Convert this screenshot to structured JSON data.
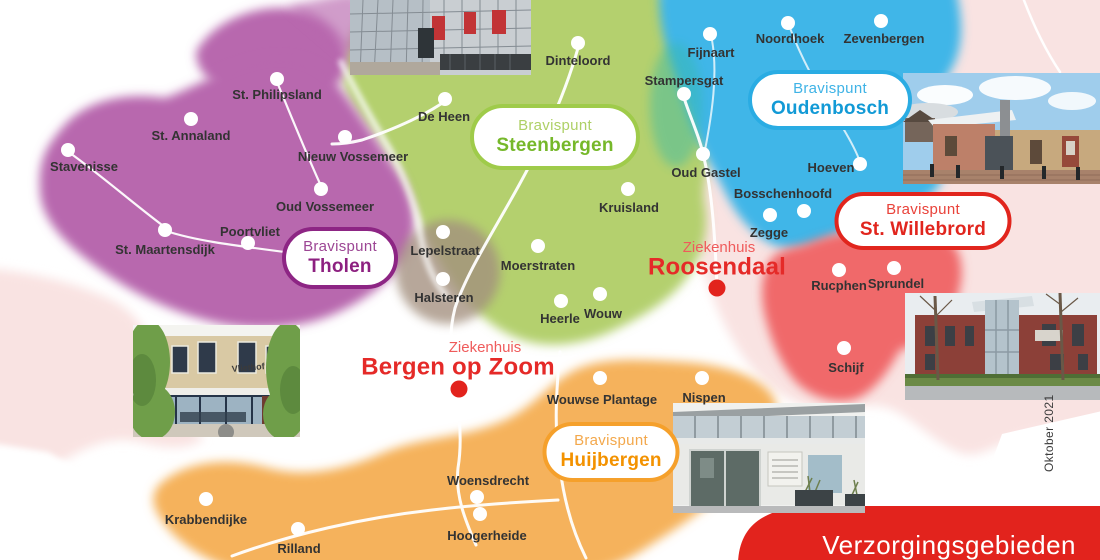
{
  "banner": {
    "label": "Verzorgingsgebieden",
    "color": "#e2231d",
    "text_color": "#ffffff"
  },
  "date_label": "Oktober 2021",
  "regions": {
    "tholen": "#b868ae",
    "steenbergen": "#b4d06e",
    "oudenbosch": "#3fb6e8",
    "st_willebrord": "#f0696b",
    "huijbergen": "#f5b25c",
    "background_land": "#f9e3e2",
    "water": "#ffffff",
    "blend_teal": "#35b9a9",
    "blend_gray": "#a38f7e",
    "road": "#ffffff",
    "town_dot": "#ffffff"
  },
  "badges": [
    {
      "line1": "Bravispunt",
      "line2": "Steenbergen",
      "border": "#9fcb4a",
      "c1": "#aed066",
      "c2": "#76b82a",
      "x": 555,
      "y": 137,
      "w": 170,
      "h": 66
    },
    {
      "line1": "Bravispunt",
      "line2": "Tholen",
      "border": "#8d2584",
      "c1": "#9c4694",
      "c2": "#8d2080",
      "x": 340,
      "y": 258,
      "w": 116,
      "h": 62
    },
    {
      "line1": "Bravispunt",
      "line2": "Oudenbosch",
      "border": "#2aace3",
      "c1": "#3fb3e6",
      "c2": "#129ad6",
      "x": 830,
      "y": 100,
      "w": 164,
      "h": 60
    },
    {
      "line1": "Bravispunt",
      "line2": "St. Willebrord",
      "border": "#e1251d",
      "c1": "#e9423a",
      "c2": "#e1251d",
      "x": 923,
      "y": 221,
      "w": 177,
      "h": 58
    },
    {
      "line1": "Bravispunt",
      "line2": "Huijbergen",
      "border": "#f5a02b",
      "c1": "#f3a84c",
      "c2": "#f39200",
      "x": 611,
      "y": 452,
      "w": 137,
      "h": 60
    }
  ],
  "hospitals": [
    {
      "line1": "Ziekenhuis",
      "line2": "Roosendaal",
      "l1x": 719,
      "l1y": 248,
      "l2x": 717,
      "l2y": 267,
      "dot_x": 717,
      "dot_y": 288
    },
    {
      "line1": "Ziekenhuis",
      "line2": "Bergen op Zoom",
      "l1x": 485,
      "l1y": 348,
      "l2x": 458,
      "l2y": 367,
      "dot_x": 459,
      "dot_y": 389
    }
  ],
  "hospital_colors": {
    "line1": "#ef5b5b",
    "line2": "#e52a28",
    "dot": "#e2231d"
  },
  "towns": [
    {
      "name": "St. Philipsland",
      "x": 277,
      "y": 79,
      "lx": 277,
      "ly": 94
    },
    {
      "name": "St. Annaland",
      "x": 191,
      "y": 119,
      "lx": 191,
      "ly": 135
    },
    {
      "name": "Stavenisse",
      "x": 68,
      "y": 150,
      "lx": 84,
      "ly": 166
    },
    {
      "name": "Nieuw Vossemeer",
      "x": 345,
      "y": 137,
      "lx": 353,
      "ly": 156
    },
    {
      "name": "Oud Vossemeer",
      "x": 321,
      "y": 189,
      "lx": 325,
      "ly": 206
    },
    {
      "name": "Poortvliet",
      "x": 248,
      "y": 243,
      "lx": 250,
      "ly": 231
    },
    {
      "name": "St. Maartensdijk",
      "x": 165,
      "y": 230,
      "lx": 165,
      "ly": 249
    },
    {
      "name": "De Heen",
      "x": 445,
      "y": 99,
      "lx": 444,
      "ly": 116
    },
    {
      "name": "Dinteloord",
      "x": 578,
      "y": 43,
      "lx": 578,
      "ly": 60
    },
    {
      "name": "Stampersgat",
      "x": 684,
      "y": 94,
      "lx": 684,
      "ly": 80
    },
    {
      "name": "Fijnaart",
      "x": 710,
      "y": 34,
      "lx": 711,
      "ly": 52
    },
    {
      "name": "Noordhoek",
      "x": 788,
      "y": 23,
      "lx": 790,
      "ly": 38
    },
    {
      "name": "Zevenbergen",
      "x": 881,
      "y": 21,
      "lx": 884,
      "ly": 38
    },
    {
      "name": "Oud Gastel",
      "x": 703,
      "y": 154,
      "lx": 706,
      "ly": 172
    },
    {
      "name": "Hoeven",
      "x": 860,
      "y": 164,
      "lx": 831,
      "ly": 167
    },
    {
      "name": "Bosschenhoofd",
      "x": 804,
      "y": 211,
      "lx": 783,
      "ly": 193
    },
    {
      "name": "Kruisland",
      "x": 628,
      "y": 189,
      "lx": 629,
      "ly": 207
    },
    {
      "name": "Zegge",
      "x": 770,
      "y": 215,
      "lx": 769,
      "ly": 232
    },
    {
      "name": "Lepelstraat",
      "x": 443,
      "y": 232,
      "lx": 445,
      "ly": 250
    },
    {
      "name": "Moerstraten",
      "x": 538,
      "y": 246,
      "lx": 538,
      "ly": 265
    },
    {
      "name": "Halsteren",
      "x": 443,
      "y": 279,
      "lx": 444,
      "ly": 297
    },
    {
      "name": "Heerle",
      "x": 561,
      "y": 301,
      "lx": 560,
      "ly": 318
    },
    {
      "name": "Wouw",
      "x": 600,
      "y": 294,
      "lx": 603,
      "ly": 313
    },
    {
      "name": "Wouwse Plantage",
      "x": 600,
      "y": 378,
      "lx": 602,
      "ly": 399
    },
    {
      "name": "Nispen",
      "x": 702,
      "y": 378,
      "lx": 704,
      "ly": 397
    },
    {
      "name": "Schijf",
      "x": 844,
      "y": 348,
      "lx": 846,
      "ly": 367
    },
    {
      "name": "Rucphen",
      "x": 839,
      "y": 270,
      "lx": 839,
      "ly": 285
    },
    {
      "name": "Sprundel",
      "x": 894,
      "y": 268,
      "lx": 896,
      "ly": 283
    },
    {
      "name": "Woensdrecht",
      "x": 477,
      "y": 497,
      "lx": 488,
      "ly": 480
    },
    {
      "name": "Hoogerheide",
      "x": 480,
      "y": 514,
      "lx": 487,
      "ly": 535
    },
    {
      "name": "Krabbendijke",
      "x": 206,
      "y": 499,
      "lx": 206,
      "ly": 519
    },
    {
      "name": "Rilland",
      "x": 298,
      "y": 529,
      "lx": 299,
      "ly": 548
    }
  ],
  "photos": [
    {
      "name": "bravis-glass-building-photo"
    },
    {
      "name": "bravispunt-oudenbosch-photo"
    },
    {
      "name": "medisch-centrum-parkzicht-photo"
    },
    {
      "name": "vliethof-building-photo",
      "sign": "Vliethof"
    },
    {
      "name": "bravispunt-huijbergen-photo"
    }
  ]
}
